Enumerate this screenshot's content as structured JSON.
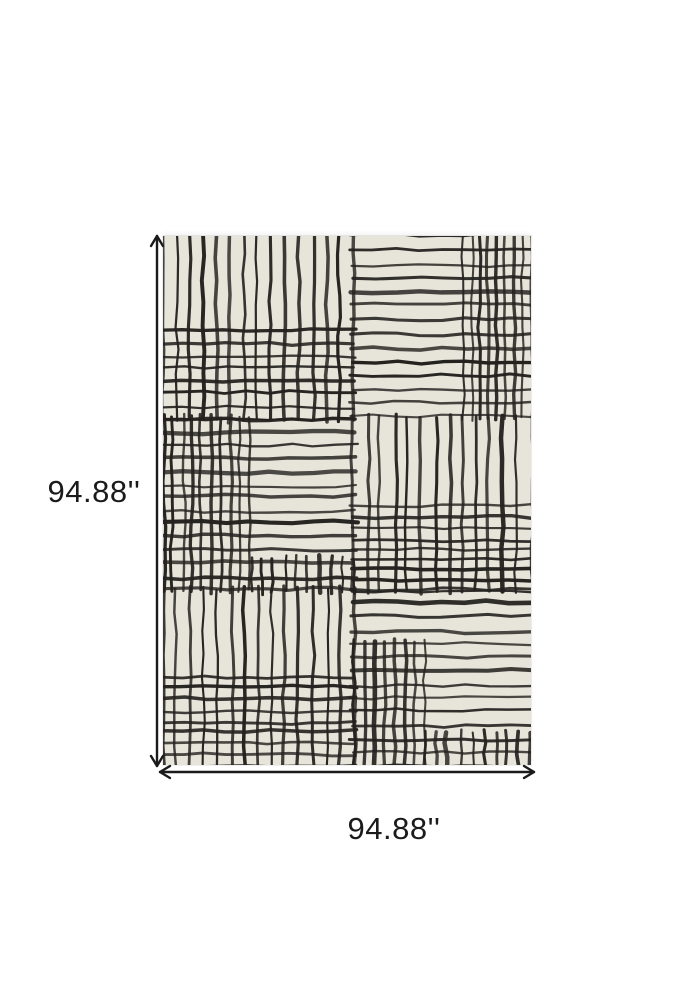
{
  "page": {
    "background": "#ffffff"
  },
  "diagram": {
    "height_label": "94.88''",
    "width_label": "94.88''",
    "arrow_color": "#1a1a1a",
    "label_color": "#1b1b1b"
  },
  "rug": {
    "background_color": "#e7e4da",
    "line_color": "#24221f",
    "width_px": 368,
    "height_px": 529,
    "spacing_px": 13.5,
    "wobble_px": 3.2,
    "seed": 11,
    "rows": [
      0,
      0.344,
      0.669,
      1.0
    ],
    "cols": [
      0,
      0.517,
      1.0
    ],
    "cells": [
      {
        "name": "top-left",
        "x0": 0,
        "x1": 0.517,
        "y0": 0,
        "y1": 0.344,
        "pattern": "vertical",
        "overlays": [
          {
            "direction": "horizontal",
            "x0": 0,
            "x1": 1,
            "y0": 0.52,
            "y1": 1.0,
            "spacing": 13
          }
        ]
      },
      {
        "name": "top-right",
        "x0": 0.517,
        "x1": 1,
        "y0": 0,
        "y1": 0.344,
        "pattern": "horizontal",
        "overlays": [
          {
            "direction": "vertical",
            "x0": 0.62,
            "x1": 1,
            "y0": 0,
            "y1": 1.0,
            "spacing": 9
          }
        ]
      },
      {
        "name": "middle-left",
        "x0": 0,
        "x1": 0.517,
        "y0": 0.344,
        "y1": 0.669,
        "pattern": "horizontal",
        "overlays": [
          {
            "direction": "vertical",
            "x0": 0,
            "x1": 0.46,
            "y0": 0,
            "y1": 1.0,
            "spacing": 9.5
          },
          {
            "direction": "vertical",
            "x0": 0.46,
            "x1": 1,
            "y0": 0.82,
            "y1": 1.0,
            "spacing": 12
          }
        ]
      },
      {
        "name": "middle-right",
        "x0": 0.517,
        "x1": 1,
        "y0": 0.344,
        "y1": 0.669,
        "pattern": "vertical",
        "overlays": [
          {
            "direction": "horizontal",
            "x0": 0,
            "x1": 1,
            "y0": 0.52,
            "y1": 1.0,
            "spacing": 11
          }
        ]
      },
      {
        "name": "bottom-left",
        "x0": 0,
        "x1": 0.517,
        "y0": 0.669,
        "y1": 1.0,
        "pattern": "vertical",
        "overlays": [
          {
            "direction": "horizontal",
            "x0": 0,
            "x1": 1,
            "y0": 0.5,
            "y1": 1.0,
            "spacing": 11
          }
        ]
      },
      {
        "name": "bottom-right",
        "x0": 0.517,
        "x1": 1,
        "y0": 0.669,
        "y1": 1.0,
        "pattern": "horizontal",
        "overlays": [
          {
            "direction": "vertical",
            "x0": 0,
            "x1": 0.4,
            "y0": 0.3,
            "y1": 1.0,
            "spacing": 10
          },
          {
            "direction": "vertical",
            "x0": 0.4,
            "x1": 1,
            "y0": 0.82,
            "y1": 1.0,
            "spacing": 12
          }
        ]
      }
    ]
  }
}
